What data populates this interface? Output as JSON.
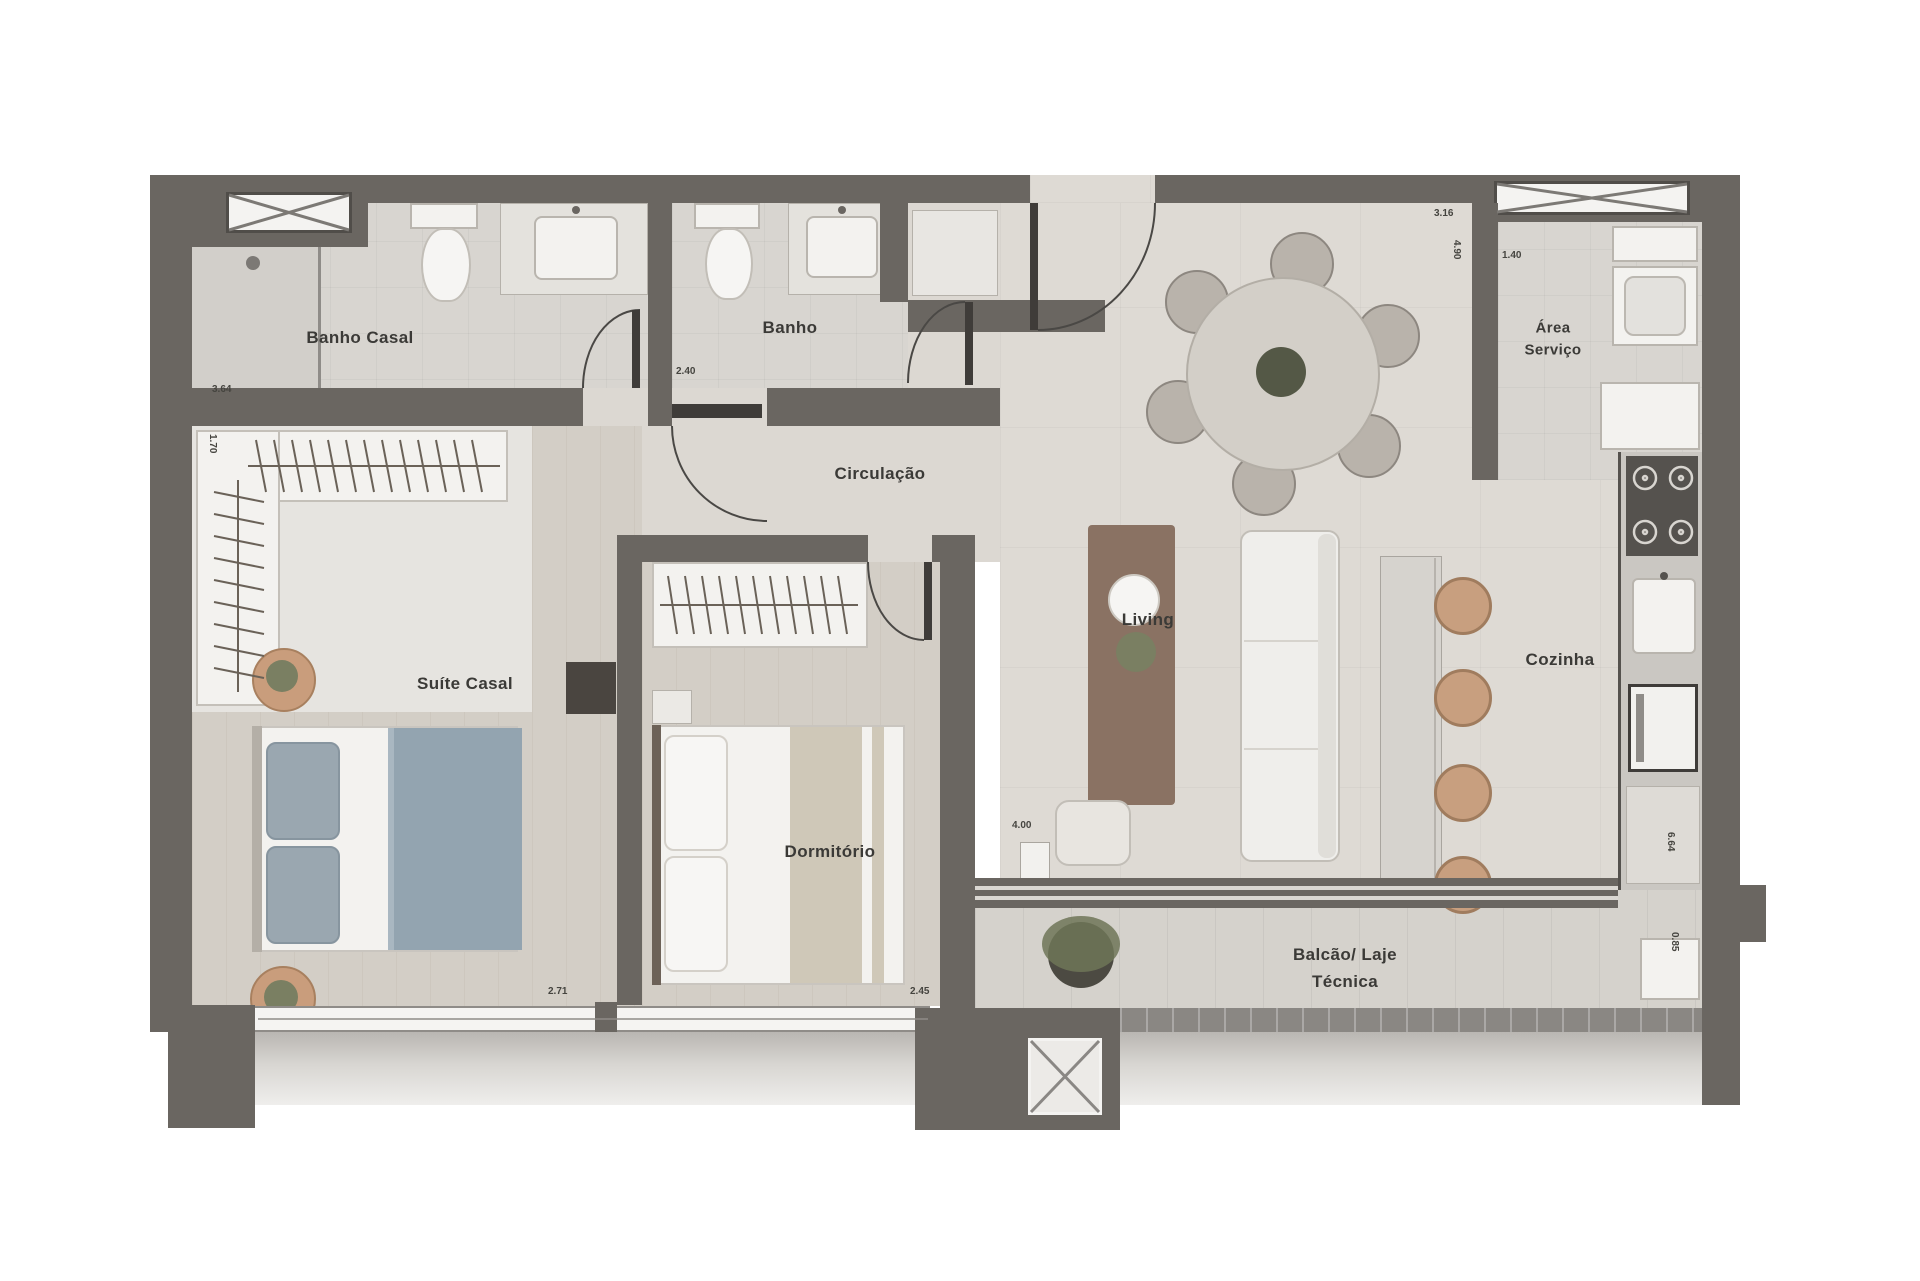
{
  "title": "Planta baixa de apartamento (floor plan render)",
  "rooms": {
    "banho_casal": {
      "label": "Banho Casal"
    },
    "banho": {
      "label": "Banho"
    },
    "circulacao": {
      "label": "Circulação"
    },
    "suite_casal": {
      "label": "Suíte Casal"
    },
    "dormitorio": {
      "label": "Dormitório"
    },
    "living": {
      "label": "Living"
    },
    "cozinha": {
      "label": "Cozinha"
    },
    "area_servico": {
      "line1": "Área",
      "line2": "Serviço"
    },
    "balcao": {
      "line1": "Balcão/ Laje",
      "line2": "Técnica"
    }
  },
  "dimensions": {
    "banho_casal_width": "3.64",
    "banho_width": "2.40",
    "closet_depth": "1.70",
    "suite_width": "2.71",
    "dormitorio_width": "2.45",
    "living_length": "4.00",
    "dining_width": "3.16",
    "dining_length": "4.90",
    "area_servico_width": "1.40",
    "cozinha_length": "6.64",
    "balcao_depth": "0.85"
  },
  "colors": {
    "wall": "#6a6661",
    "floor_base": "#dcd8d2",
    "floor_bedroom": "#d3cec6",
    "bed_blanket_blue": "#93a4b0",
    "bed_blanket_beige": "#cfc8b8",
    "rug_wood_brown": "#8a7263",
    "stool_tan": "#c89f7f",
    "greenery": "#6f7557",
    "label_text": "#3b3a37"
  }
}
